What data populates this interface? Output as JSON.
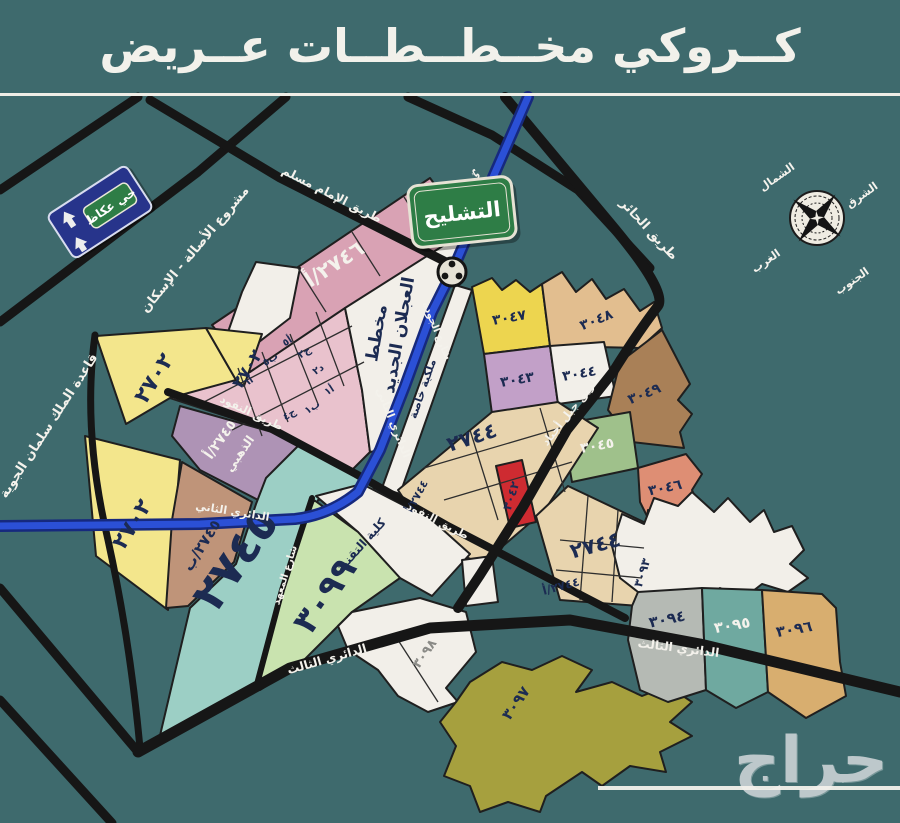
{
  "header": {
    "title": "كــروكي مخــطــطــات عــريض"
  },
  "watermark": {
    "text": "حراج"
  },
  "colors": {
    "background": "#3E6A6D",
    "road_black": "#161616",
    "ring_blue": "#2B50D6",
    "ring_blue_dark": "#16297E",
    "pink_strip": "#D9A2B4",
    "pink_grid": "#E9C2CD",
    "yellow_2702": "#F3E68C",
    "yellow_3047": "#EDD54F",
    "purple_gold": "#AE93B5",
    "brown_2745b": "#BF9479",
    "teal_2745": "#9CCFC5",
    "green_3099": "#C9E3AF",
    "beige_2744": "#E8D4AE",
    "tan_3048": "#E2BE8F",
    "brown_3049": "#A98057",
    "green_3045": "#9FC18B",
    "salmon_3046": "#DE8E74",
    "red_3042": "#CE2B31",
    "lilac_3043": "#C2A0C8",
    "white_zone": "#F2EFE9",
    "gray_3094": "#B5BAB4",
    "teal_3095": "#6FA9A0",
    "tan_3096": "#D8AE6F",
    "olive_3097": "#A6A03E",
    "strip_3093": "#C8BD9F",
    "sign_green": "#2E7D46",
    "sign_navy": "#27348B",
    "label_navy": "#1C2B52"
  },
  "roads": {
    "imam_muslim": "طريق الإمام مسلم",
    "hair": "طريق الحائر",
    "jabal_ajyad": "طريق جبل أجياد",
    "nofoud": "طريق النفود",
    "second_ring": "الدائري الثاني",
    "third_ring": "الدائري الثالث",
    "jawda": "شارع الجودة",
    "maahad": "شارع المعهد"
  },
  "areas": {
    "asala": "مشروع الأصالة - الإسكان",
    "airbase": "قاعدة الملك سلمان الجوية",
    "ajlan_1": "مخطط",
    "ajlan_2": "العجلان الجديد",
    "melkia": "ملكية خاصة",
    "college": "كلية التقنية"
  },
  "signs": {
    "okaz": "حي عكاظ",
    "tashleeh": "التشليح"
  },
  "compass": {
    "north": "الشمال",
    "east": "الشرق",
    "west": "الغرب",
    "south": "الجنوب"
  },
  "zones": {
    "z2746a": "٢٧٤٦/أ",
    "z2702": "٢٧٠٢",
    "z2745_gold_a": "٢٧٤٥/أ",
    "z2745_gold_b": "الذهبي",
    "z2745b": "٢٧٤٥/ب",
    "z2745": "٢٧٤٥",
    "z2744": "٢٧٤٤",
    "z2744a": "٢٧٤٤/أ",
    "z3042": "٣٠٤٢",
    "z3043": "٣٠٤٣",
    "z3044": "٣٠٤٤",
    "z3045": "٣٠٤٥",
    "z3046": "٣٠٤٦",
    "z3047": "٣٠٤٧",
    "z3048": "٣٠٤٨",
    "z3049": "٣٠٤٩",
    "z3093": "٣٠٩٣",
    "z3094": "٣٠٩٤",
    "z3095": "٣٠٩٥",
    "z3096": "٣٠٩٦",
    "z3097": "٣٠٩٧",
    "z3098": "٣٠٩٨",
    "z3099": "٣٠٩٩",
    "cells": {
      "c1": "أ٥",
      "c2": "ب٥",
      "c3": "أ٦",
      "c4": "ج٢",
      "c5": "د٢",
      "c6": "أ١",
      "c7": "ب١",
      "c8": "ج٤"
    }
  }
}
